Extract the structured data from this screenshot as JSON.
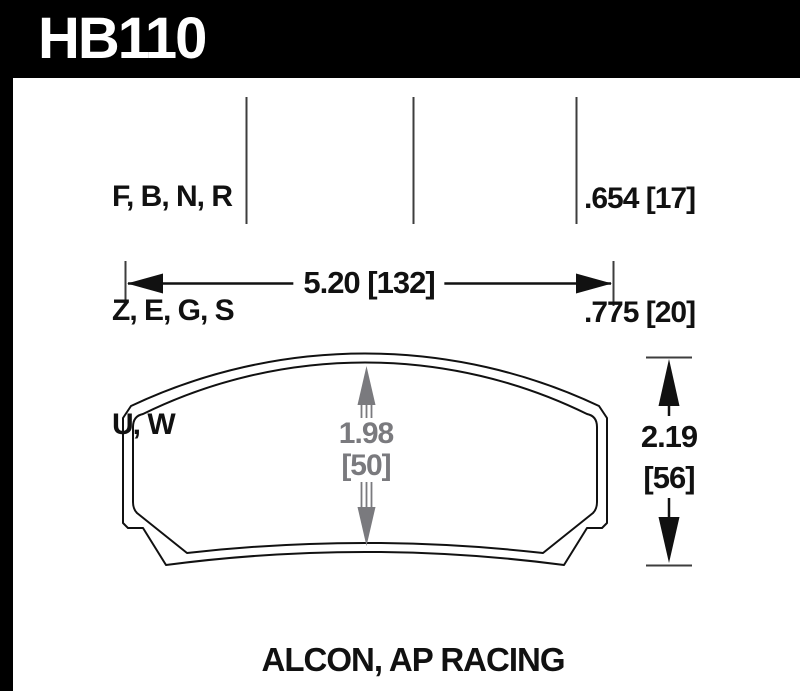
{
  "header": {
    "part_number": "HB110"
  },
  "compound_table": {
    "rows": [
      "F, B, N, R",
      "Z, E, G, S",
      "U, W"
    ],
    "pad_thickness": [
      ".654 [17]",
      ".775 [20]"
    ]
  },
  "dimensions": {
    "width_label": "5.20 [132]",
    "height_in": "2.19",
    "height_mm": "[56]",
    "center_in": "1.98",
    "center_mm": "[50]"
  },
  "footer": {
    "applications": "ALCON, AP RACING"
  },
  "colors": {
    "header_bg": "#000000",
    "header_text": "#ffffff",
    "line_black": "#111111",
    "rule_gray": "#3d3d3d",
    "dim_gray": "#7a7a7e"
  }
}
